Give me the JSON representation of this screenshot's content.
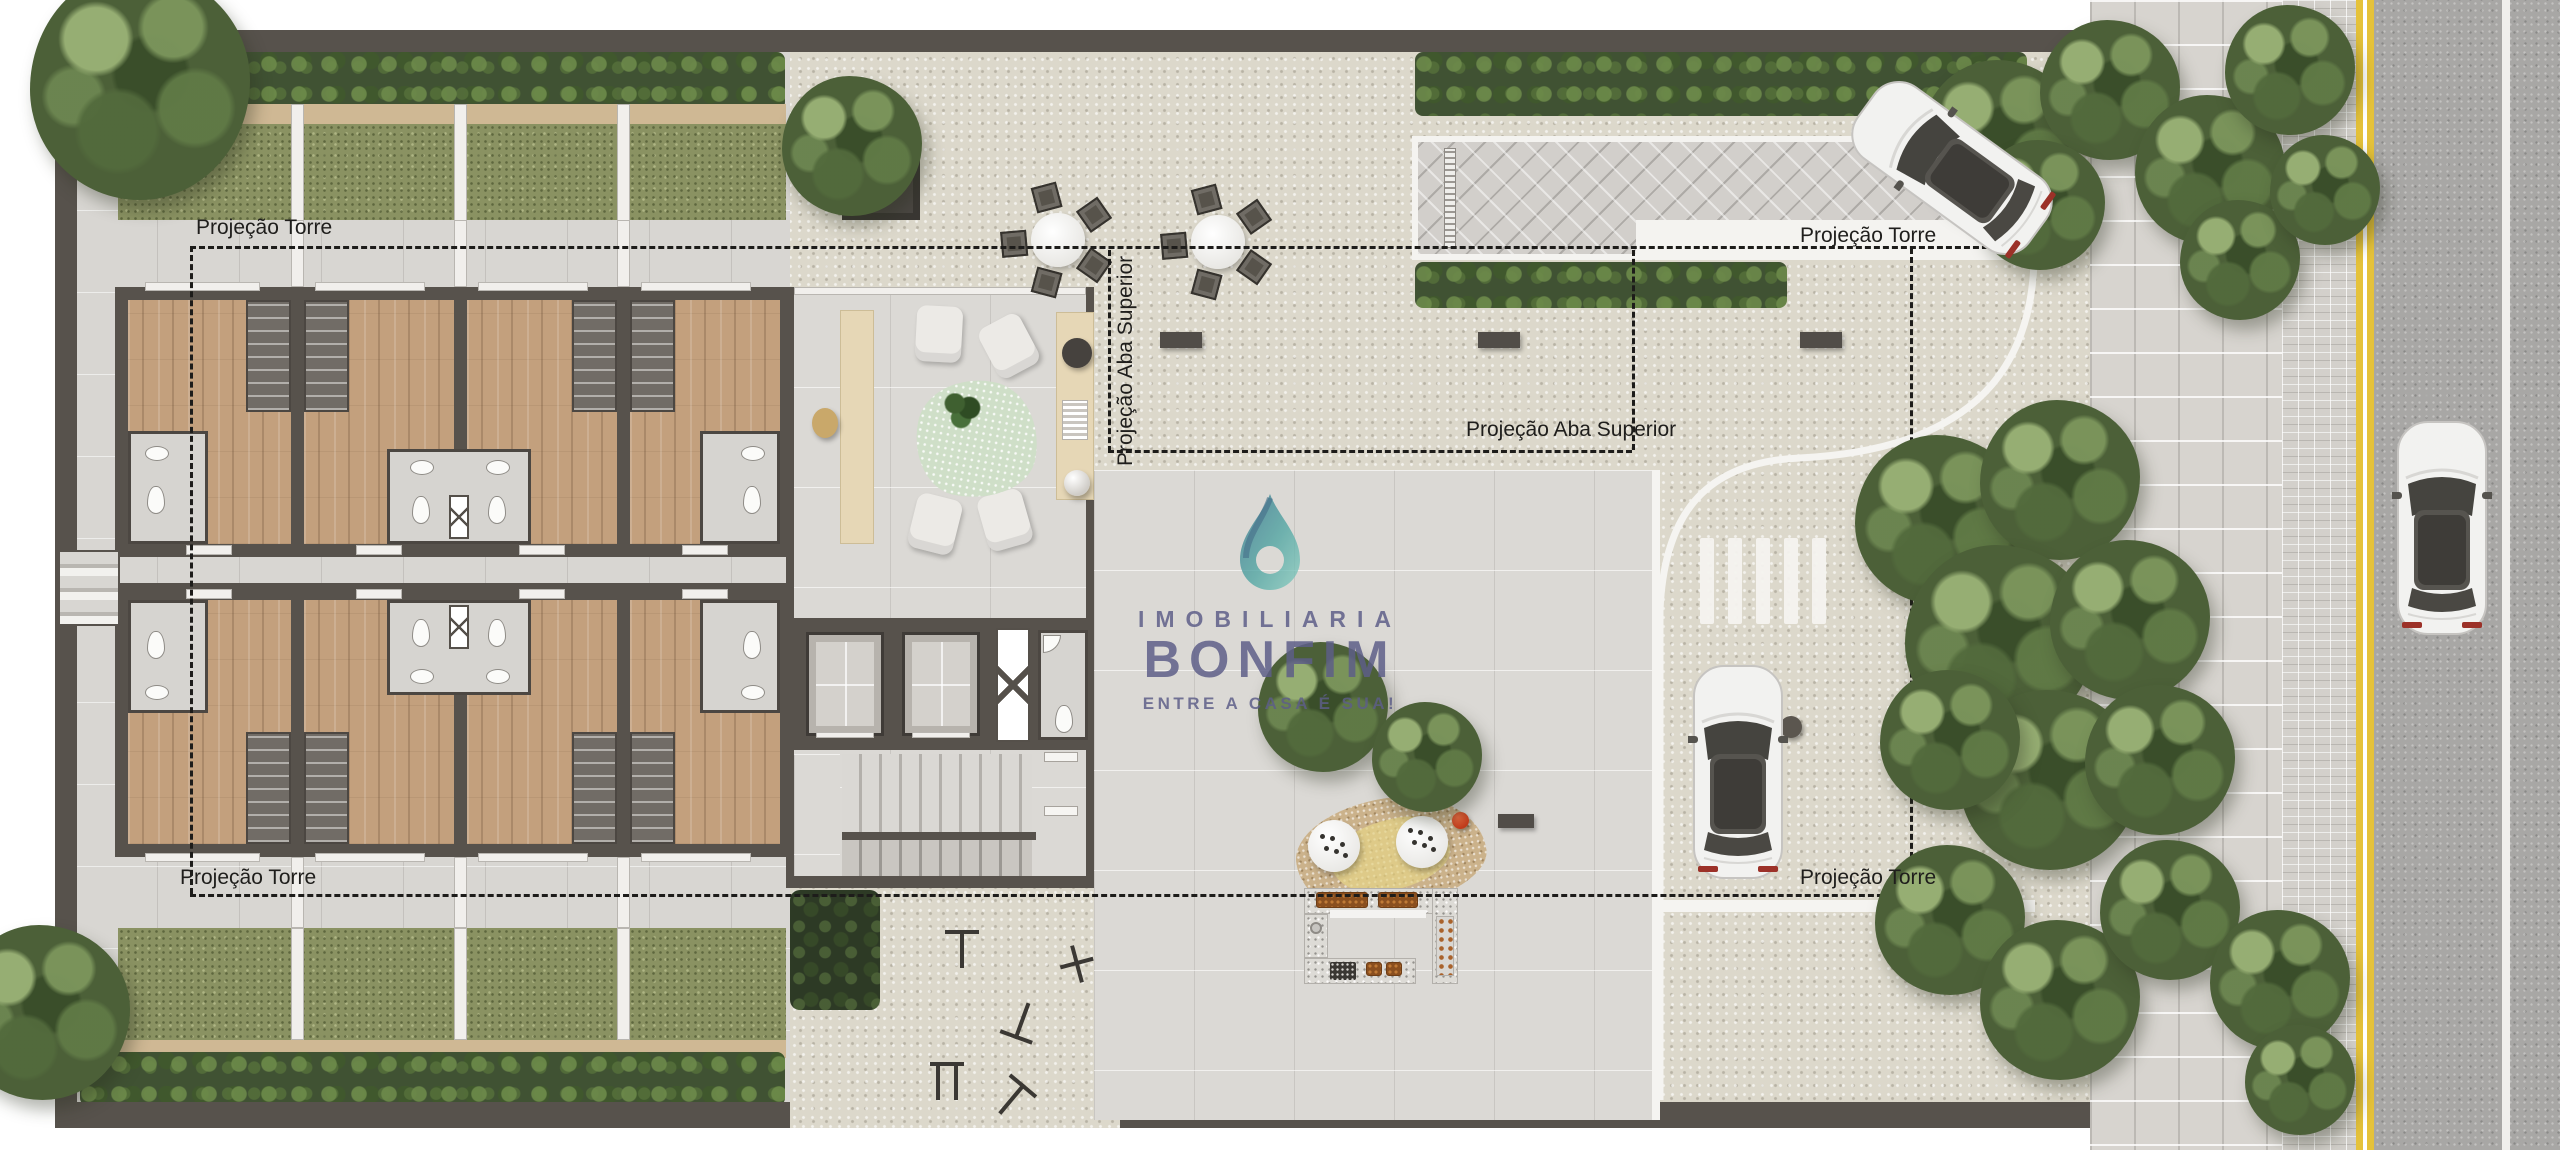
{
  "canvas": {
    "width": 2560,
    "height": 1150
  },
  "annotations": {
    "torre_top_left": "Projeção Torre",
    "torre_top_right": "Projeção Torre",
    "torre_bottom_left": "Projeção Torre",
    "torre_bottom_right": "Projeção Torre",
    "aba_superior_vertical": "Projeção Aba Superior",
    "aba_superior_horizontal": "Projeção Aba Superior"
  },
  "watermark": {
    "kicker": "IMOBILIARIA",
    "brand": "BONFIM",
    "tagline": "ENTRE A CASA É SUA!"
  },
  "palette": {
    "watermark_blue": "#5d5e88",
    "drop_teal": "#4aa3a0",
    "drop_deep": "#2f6e89",
    "road_yellow": "#e5c23a",
    "grass_green": "#8a9262",
    "hedge_green": "#405233",
    "wood_floor": "#c3a07d",
    "wall_dark": "#57524c",
    "cobble": "#dcd8cb"
  },
  "scene": {
    "type": "architectural site plan render, top view",
    "features": [
      "eight townhouse units with wood floors and bathrooms",
      "private grass gardens with hedges (top-left and bottom-left)",
      "lobby with reception desk, lounge chairs, rug and console",
      "two elevators, ventilation shaft, accessible wc, double stair flights",
      "outdoor gym on cobblestone",
      "two round dining tables with five chairs each",
      "kids play area with two white tables, red ball and bench",
      "u-shaped barbecue kitchen counter",
      "vehicle driveway with herringbone pavers and drain",
      "pedestrian crosswalk",
      "parked white car and white car leaving driveway",
      "street with double yellow line, white lane line and white car",
      "paver sidewalk and brick strip",
      "tree clusters and shrubs"
    ]
  }
}
